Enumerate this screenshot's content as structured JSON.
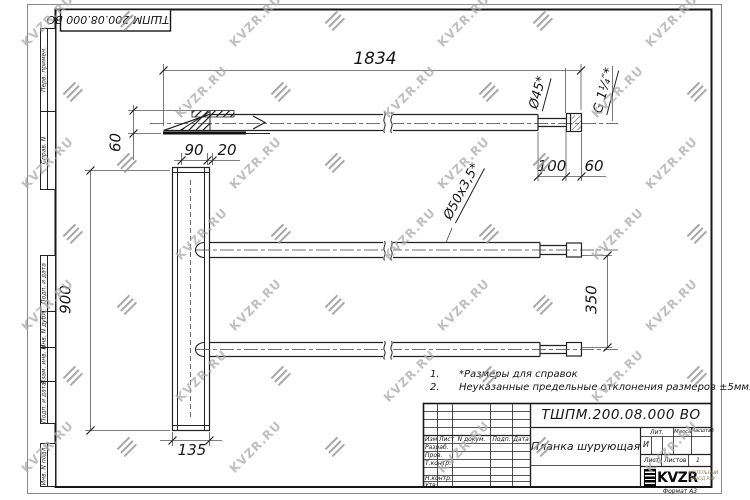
{
  "watermark": {
    "text": "KVZR.RU"
  },
  "stamp_top": {
    "doc_number": "ТШПМ.200.08.000 ВО"
  },
  "margin_labels": {
    "perv": "Перв. примен.",
    "sprav": "Справ. N",
    "podp1": "Подп. и дата",
    "inv_dubl": "Инв. N дубл.",
    "vzam": "Взам. инв. N",
    "podp2": "Подп. и дата",
    "inv_podl": "Инв. N подл."
  },
  "dims": {
    "length": "1834",
    "bracket_height": "60",
    "plate_top_1": "90",
    "plate_top_2": "20",
    "plate_height": "900",
    "plate_width": "135",
    "tube_spacing": "350",
    "end_length": "100",
    "thread_length": "60",
    "dia_label": "Ø45*",
    "thread_label": "G 1¼″*",
    "tube_label": "Ø50х3,5*"
  },
  "notes": {
    "n1_num": "1.",
    "n1_text": "*Размеры для справок",
    "n2_num": "2.",
    "n2_text": "Неуказанные предельные отклонения размеров ±5мм."
  },
  "title_block": {
    "doc_number": "ТШПМ.200.08.000 ВО",
    "part_name": "Планка шурующая",
    "header": {
      "izm": "Изм",
      "list": "Лист",
      "ndoc": "N докум.",
      "podp": "Подп.",
      "data": "Дата"
    },
    "rows": [
      {
        "label": "Разраб."
      },
      {
        "label": "Пров."
      },
      {
        "label": "Т.контр."
      },
      {
        "label": ""
      },
      {
        "label": "Н.контр."
      },
      {
        "label": "Утв."
      }
    ],
    "lit_header": "Лит.",
    "massa_header": "Масса",
    "masshtab_header": "Масштаб",
    "lit_value": "И",
    "list_label": "Лист",
    "listov_label": "Листов",
    "listov_value": "1",
    "logo_text": "KVZR",
    "logo_sub1": "КОТЕЛЬНЫЙ",
    "logo_sub2": "ЗАВОД РЭУ",
    "format_label": "Формат А3"
  }
}
